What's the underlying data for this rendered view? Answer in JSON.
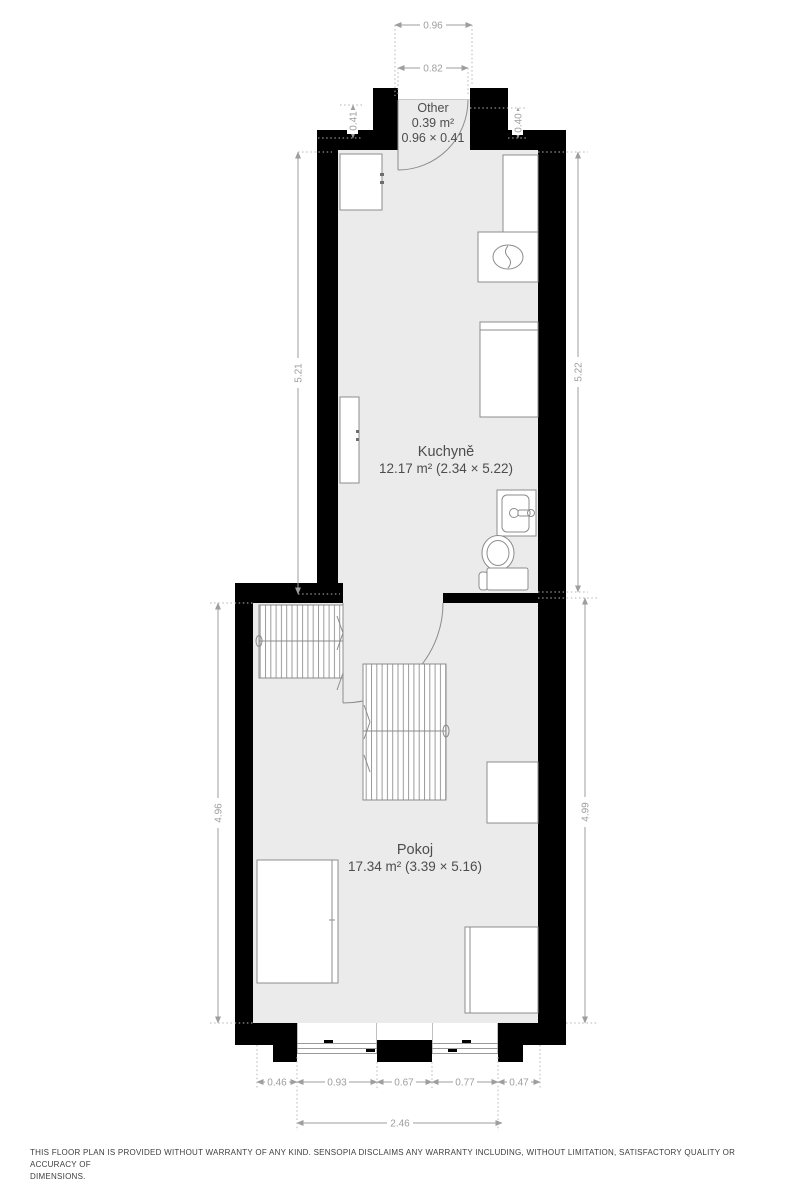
{
  "plan_type": "floor-plan",
  "colors": {
    "wall": "#000000",
    "floor_fill": "#ebebeb",
    "furniture_stroke": "#8c8c8c",
    "dimension": "#9e9e9e",
    "room_label": "#4d4d4d"
  },
  "rooms": {
    "other": {
      "name": "Other",
      "area": "0.39 m²",
      "size": "0.96 × 0.41"
    },
    "kitchen": {
      "name": "Kuchyně",
      "details": "12.17 m² (2.34 × 5.22)"
    },
    "room": {
      "name": "Pokoj",
      "details": "17.34 m² (3.39 × 5.16)"
    }
  },
  "dimensions": {
    "entry_outer_width": "0.96",
    "entry_opening_width": "0.82",
    "entry_depth_left": "0.41",
    "entry_depth_right": "0.40",
    "kitchen_length_left": "5.21",
    "kitchen_length_right": "5.22",
    "room_length_left": "4.96",
    "room_length_right": "4.99",
    "bottom_chain": [
      "0.46",
      "0.93",
      "0.67",
      "0.77",
      "0.47"
    ],
    "bottom_total": "2.46"
  },
  "footer": {
    "disclaimer_line1": "THIS FLOOR PLAN IS PROVIDED WITHOUT WARRANTY OF ANY KIND. SENSOPIA DISCLAIMS ANY WARRANTY INCLUDING, WITHOUT LIMITATION, SATISFACTORY QUALITY OR ACCURACY OF",
    "disclaimer_line2": "DIMENSIONS."
  }
}
